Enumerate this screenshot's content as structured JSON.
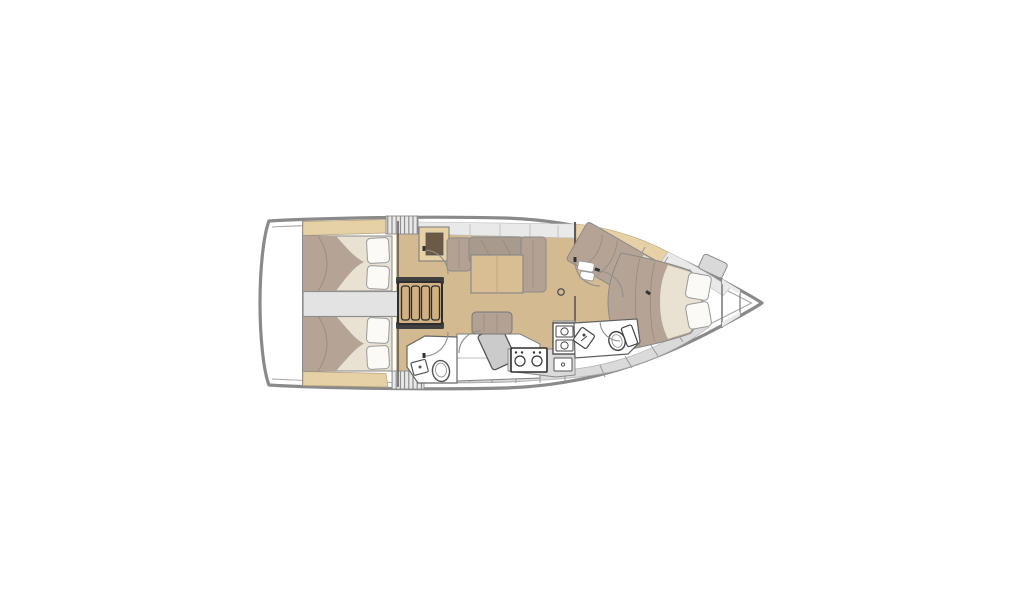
{
  "meta": {
    "type": "sailboat-interior-floor-plan",
    "orientation": "bow-right",
    "background": "#ffffff"
  },
  "palette": {
    "page_bg": "#ffffff",
    "hull_fill": "#ffffff",
    "hull_outline": "#8a8a8a",
    "inner_line": "#a8a8a8",
    "wall": "#4f4f4f",
    "furniture_outline": "#6b6b6b",
    "dark_outline": "#2d2d2d",
    "deck_gray": "#e9e9e9",
    "locker_gray": "#dadada",
    "corridor_gray": "#e3e3e3",
    "fixture_gray": "#cbcbcb",
    "floor_wood": "#d4ba90",
    "trim_wood": "#e6d0a6",
    "table_wood": "#d9be94",
    "steps_wood": "#cfb184",
    "mattress": "#b5a495",
    "cushion": "#b3a294",
    "cushion_dark": "#a89a8d",
    "crease": "#9b8a79",
    "sheet_cream": "#e9e1d2",
    "pillow": "#fbfaf7",
    "dark_inset": "#6d5a45",
    "tick": "#9a9a9a"
  },
  "areas": [
    {
      "id": "swim-platform",
      "label": "swim platform transom"
    },
    {
      "id": "aft-cabin-port",
      "label": "aft double berth port"
    },
    {
      "id": "aft-cabin-starboard",
      "label": "aft double berth starboard"
    },
    {
      "id": "engine-corridor",
      "label": "center corridor engine box"
    },
    {
      "id": "companionway-steps",
      "label": "companionway steps"
    },
    {
      "id": "salon",
      "label": "salon settee and table"
    },
    {
      "id": "nav-bench",
      "label": "salon bench and chart table"
    },
    {
      "id": "aft-head",
      "label": "aft head toilet and sink"
    },
    {
      "id": "galley",
      "label": "galley stove and double sink"
    },
    {
      "id": "mid-cabin",
      "label": "mid diagonal berth"
    },
    {
      "id": "forward-cabin",
      "label": "forward V-berth"
    },
    {
      "id": "forward-head",
      "label": "forward head toilet and sink"
    },
    {
      "id": "bow-locker",
      "label": "bow anchor locker"
    }
  ]
}
